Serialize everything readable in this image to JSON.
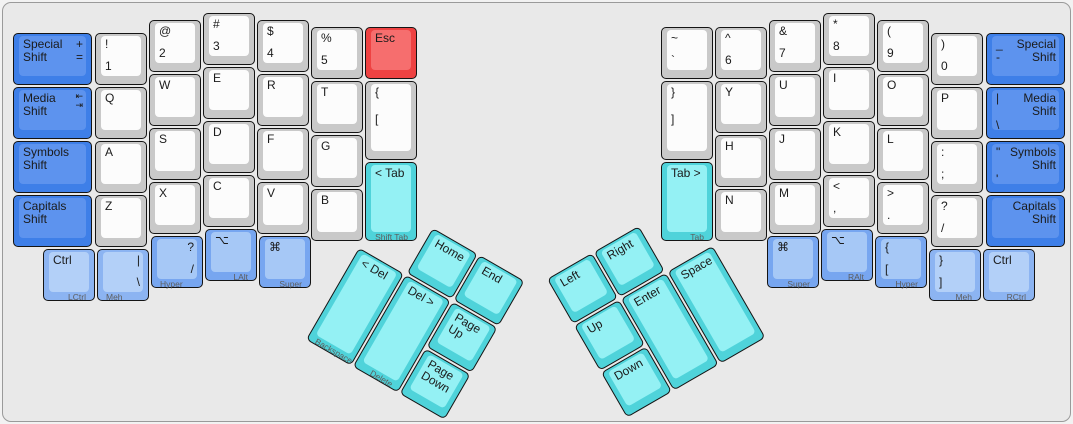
{
  "canvas": {
    "background": "#e9e9e9",
    "border_color": "#9a9a9a",
    "unit_px": 54,
    "colors": {
      "white_side": "#c9c9c9",
      "white_top": "#fcfcfc",
      "blue_side": "#3e7fe8",
      "blue_top": "#5d93ee",
      "light_blue_side": "#8cb4f2",
      "light_blue_top": "#b3d0f8",
      "medium_blue_side": "#77a6f0",
      "medium_blue_top": "#a6c8f6",
      "cyan_side": "#4fd3da",
      "cyan_top": "#94f1f4",
      "red_side": "#ee4242",
      "red_top": "#f66e6e"
    }
  },
  "left_main": [
    {
      "n": "key-special-shift-left",
      "x": 10,
      "y": 30,
      "w": 1.5,
      "c": "blue",
      "tl": "Special\nShift",
      "tr": "+\n="
    },
    {
      "n": "key-media-shift-left",
      "x": 10,
      "y": 84,
      "w": 1.5,
      "c": "blue",
      "tl": "Media\nShift",
      "tr": "⇤\n⇥",
      "sm": true,
      "tr_icon": "tab-arrows-icon"
    },
    {
      "n": "key-symbols-shift-left",
      "x": 10,
      "y": 138,
      "w": 1.5,
      "c": "blue",
      "tl": "Symbols\nShift"
    },
    {
      "n": "key-capitals-shift-left",
      "x": 10,
      "y": 192,
      "w": 1.5,
      "c": "blue",
      "tl": "Capitals\nShift"
    },
    {
      "n": "key-1",
      "x": 92,
      "y": 30,
      "c": "white",
      "tl": "!",
      "bl": "1"
    },
    {
      "n": "key-q",
      "x": 92,
      "y": 84,
      "c": "white",
      "tl": "Q"
    },
    {
      "n": "key-a",
      "x": 92,
      "y": 138,
      "c": "white",
      "tl": "A"
    },
    {
      "n": "key-z",
      "x": 92,
      "y": 192,
      "c": "white",
      "tl": "Z"
    },
    {
      "n": "key-2",
      "x": 146,
      "y": 17,
      "c": "white",
      "tl": "@",
      "bl": "2"
    },
    {
      "n": "key-w",
      "x": 146,
      "y": 71,
      "c": "white",
      "tl": "W"
    },
    {
      "n": "key-s",
      "x": 146,
      "y": 125,
      "c": "white",
      "tl": "S"
    },
    {
      "n": "key-x",
      "x": 146,
      "y": 179,
      "c": "white",
      "tl": "X"
    },
    {
      "n": "key-3",
      "x": 200,
      "y": 10,
      "c": "white",
      "tl": "#",
      "bl": "3"
    },
    {
      "n": "key-e",
      "x": 200,
      "y": 64,
      "c": "white",
      "tl": "E"
    },
    {
      "n": "key-d",
      "x": 200,
      "y": 118,
      "c": "white",
      "tl": "D"
    },
    {
      "n": "key-c",
      "x": 200,
      "y": 172,
      "c": "white",
      "tl": "C"
    },
    {
      "n": "key-4",
      "x": 254,
      "y": 17,
      "c": "white",
      "tl": "$",
      "bl": "4"
    },
    {
      "n": "key-r",
      "x": 254,
      "y": 71,
      "c": "white",
      "tl": "R"
    },
    {
      "n": "key-f",
      "x": 254,
      "y": 125,
      "c": "white",
      "tl": "F"
    },
    {
      "n": "key-v",
      "x": 254,
      "y": 179,
      "c": "white",
      "tl": "V"
    },
    {
      "n": "key-5",
      "x": 308,
      "y": 24,
      "c": "white",
      "tl": "%",
      "bl": "5"
    },
    {
      "n": "key-t",
      "x": 308,
      "y": 78,
      "c": "white",
      "tl": "T"
    },
    {
      "n": "key-g",
      "x": 308,
      "y": 132,
      "c": "white",
      "tl": "G"
    },
    {
      "n": "key-b",
      "x": 308,
      "y": 186,
      "c": "white",
      "tl": "B"
    },
    {
      "n": "key-esc",
      "x": 362,
      "y": 24,
      "c": "red",
      "tl": "Esc"
    },
    {
      "n": "key-open-bracket-inner-left",
      "x": 362,
      "y": 78,
      "h": 1.5,
      "c": "white",
      "tl": "{",
      "bl": "["
    },
    {
      "n": "key-shift-tab",
      "x": 362,
      "y": 159,
      "h": 1.5,
      "c": "cyan",
      "tl": "< Tab",
      "fr": "Shift Tab"
    },
    {
      "n": "key-lctrl",
      "x": 40,
      "y": 246,
      "c": "lblue",
      "tl": "Ctrl",
      "fr": "LCtrl"
    },
    {
      "n": "key-meh-left",
      "x": 94,
      "y": 246,
      "c": "lblue",
      "tr": "|",
      "br": "\\",
      "fl": "Meh"
    },
    {
      "n": "key-hyper-left",
      "x": 148,
      "y": 233,
      "c": "mblue",
      "tr": "?",
      "br": "/",
      "fl": "Hyper"
    },
    {
      "n": "key-lalt",
      "x": 202,
      "y": 226,
      "c": "mblue",
      "tl": "⌥",
      "fr": "LAlt",
      "tl_icon": "option-icon"
    },
    {
      "n": "key-super-left",
      "x": 256,
      "y": 233,
      "c": "mblue",
      "tl": "⌘",
      "fr": "Super",
      "tl_icon": "command-icon"
    }
  ],
  "right_main": [
    {
      "n": "key-grave",
      "x": 658,
      "y": 24,
      "c": "white",
      "tl": "~",
      "bl": "`"
    },
    {
      "n": "key-close-bracket-inner-right",
      "x": 658,
      "y": 78,
      "h": 1.5,
      "c": "white",
      "tl": "}",
      "bl": "]"
    },
    {
      "n": "key-tab-right",
      "x": 658,
      "y": 159,
      "h": 1.5,
      "c": "cyan",
      "tl": "Tab >",
      "fr": "Tab"
    },
    {
      "n": "key-6",
      "x": 712,
      "y": 24,
      "c": "white",
      "tl": "^",
      "bl": "6"
    },
    {
      "n": "key-y",
      "x": 712,
      "y": 78,
      "c": "white",
      "tl": "Y"
    },
    {
      "n": "key-h",
      "x": 712,
      "y": 132,
      "c": "white",
      "tl": "H"
    },
    {
      "n": "key-n",
      "x": 712,
      "y": 186,
      "c": "white",
      "tl": "N"
    },
    {
      "n": "key-7",
      "x": 766,
      "y": 17,
      "c": "white",
      "tl": "&",
      "bl": "7"
    },
    {
      "n": "key-u",
      "x": 766,
      "y": 71,
      "c": "white",
      "tl": "U"
    },
    {
      "n": "key-j",
      "x": 766,
      "y": 125,
      "c": "white",
      "tl": "J"
    },
    {
      "n": "key-m",
      "x": 766,
      "y": 179,
      "c": "white",
      "tl": "M"
    },
    {
      "n": "key-8",
      "x": 820,
      "y": 10,
      "c": "white",
      "tl": "*",
      "bl": "8"
    },
    {
      "n": "key-i",
      "x": 820,
      "y": 64,
      "c": "white",
      "tl": "I"
    },
    {
      "n": "key-k",
      "x": 820,
      "y": 118,
      "c": "white",
      "tl": "K"
    },
    {
      "n": "key-comma",
      "x": 820,
      "y": 172,
      "c": "white",
      "tl": "<",
      "bl": ","
    },
    {
      "n": "key-9",
      "x": 874,
      "y": 17,
      "c": "white",
      "tl": "(",
      "bl": "9"
    },
    {
      "n": "key-o",
      "x": 874,
      "y": 71,
      "c": "white",
      "tl": "O"
    },
    {
      "n": "key-l",
      "x": 874,
      "y": 125,
      "c": "white",
      "tl": "L"
    },
    {
      "n": "key-period",
      "x": 874,
      "y": 179,
      "c": "white",
      "tl": ">",
      "bl": "."
    },
    {
      "n": "key-0",
      "x": 928,
      "y": 30,
      "c": "white",
      "tl": ")",
      "bl": "0"
    },
    {
      "n": "key-p",
      "x": 928,
      "y": 84,
      "c": "white",
      "tl": "P"
    },
    {
      "n": "key-semicolon",
      "x": 928,
      "y": 138,
      "c": "white",
      "tl": ":",
      "bl": ";"
    },
    {
      "n": "key-slash",
      "x": 928,
      "y": 192,
      "c": "white",
      "tl": "?",
      "bl": "/"
    },
    {
      "n": "key-special-shift-right",
      "x": 983,
      "y": 30,
      "w": 1.5,
      "c": "blue",
      "tl": "_\n-",
      "tr": "Special\nShift"
    },
    {
      "n": "key-media-shift-right",
      "x": 983,
      "y": 84,
      "w": 1.5,
      "c": "blue",
      "tl": "|",
      "bl": "\\",
      "tr": "Media\nShift"
    },
    {
      "n": "key-symbols-shift-right",
      "x": 983,
      "y": 138,
      "w": 1.5,
      "c": "blue",
      "tl": "\"",
      "bl": "'",
      "tr": "Symbols\nShift"
    },
    {
      "n": "key-capitals-shift-right",
      "x": 983,
      "y": 192,
      "w": 1.5,
      "c": "blue",
      "tr": "Capitals\nShift"
    },
    {
      "n": "key-super-right",
      "x": 764,
      "y": 233,
      "c": "mblue",
      "tl": "⌘",
      "fr": "Super",
      "tl_icon": "command-icon"
    },
    {
      "n": "key-ralt",
      "x": 818,
      "y": 226,
      "c": "mblue",
      "tl": "⌥",
      "fr": "RAlt",
      "tl_icon": "option-icon"
    },
    {
      "n": "key-hyper-right",
      "x": 872,
      "y": 233,
      "c": "mblue",
      "tl": "{",
      "bl": "[",
      "fr": "Hyper"
    },
    {
      "n": "key-meh-right",
      "x": 926,
      "y": 246,
      "c": "lblue",
      "tl": "}",
      "bl": "]",
      "fr": "Meh"
    },
    {
      "n": "key-rctrl",
      "x": 980,
      "y": 246,
      "c": "lblue",
      "tl": "Ctrl",
      "fr": "RCtrl"
    }
  ],
  "left_thumb": {
    "origin_x": 383,
    "origin_y": 198,
    "rotation_deg": 30,
    "keys": [
      {
        "n": "key-home",
        "x": 54,
        "y": 0,
        "c": "cyan",
        "tl": "Home"
      },
      {
        "n": "key-end",
        "x": 108,
        "y": 0,
        "c": "cyan",
        "tl": "End"
      },
      {
        "n": "key-backspace",
        "x": 0,
        "y": 54,
        "h": 2,
        "c": "cyan",
        "tl": "< Del",
        "fl": "Backspace"
      },
      {
        "n": "key-delete",
        "x": 54,
        "y": 54,
        "h": 2,
        "c": "cyan",
        "tl": "Del >",
        "fr": "Delete"
      },
      {
        "n": "key-page-up",
        "x": 108,
        "y": 54,
        "c": "cyan",
        "tl": "Page Up"
      },
      {
        "n": "key-page-down",
        "x": 108,
        "y": 108,
        "c": "cyan",
        "tl": "Page Down"
      }
    ]
  },
  "right_thumb": {
    "origin_x": 543.5,
    "origin_y": 276,
    "rotation_deg": -30,
    "keys": [
      {
        "n": "key-left",
        "x": 0,
        "y": 0,
        "c": "cyan",
        "tl": "Left"
      },
      {
        "n": "key-right",
        "x": 54,
        "y": 0,
        "c": "cyan",
        "tl": "Right"
      },
      {
        "n": "key-up",
        "x": 0,
        "y": 54,
        "c": "cyan",
        "tl": "Up"
      },
      {
        "n": "key-enter",
        "x": 54,
        "y": 54,
        "h": 2,
        "c": "cyan",
        "tl": "Enter"
      },
      {
        "n": "key-space",
        "x": 108,
        "y": 54,
        "h": 2,
        "c": "cyan",
        "tl": "Space"
      },
      {
        "n": "key-down",
        "x": 0,
        "y": 108,
        "c": "cyan",
        "tl": "Down"
      }
    ]
  }
}
